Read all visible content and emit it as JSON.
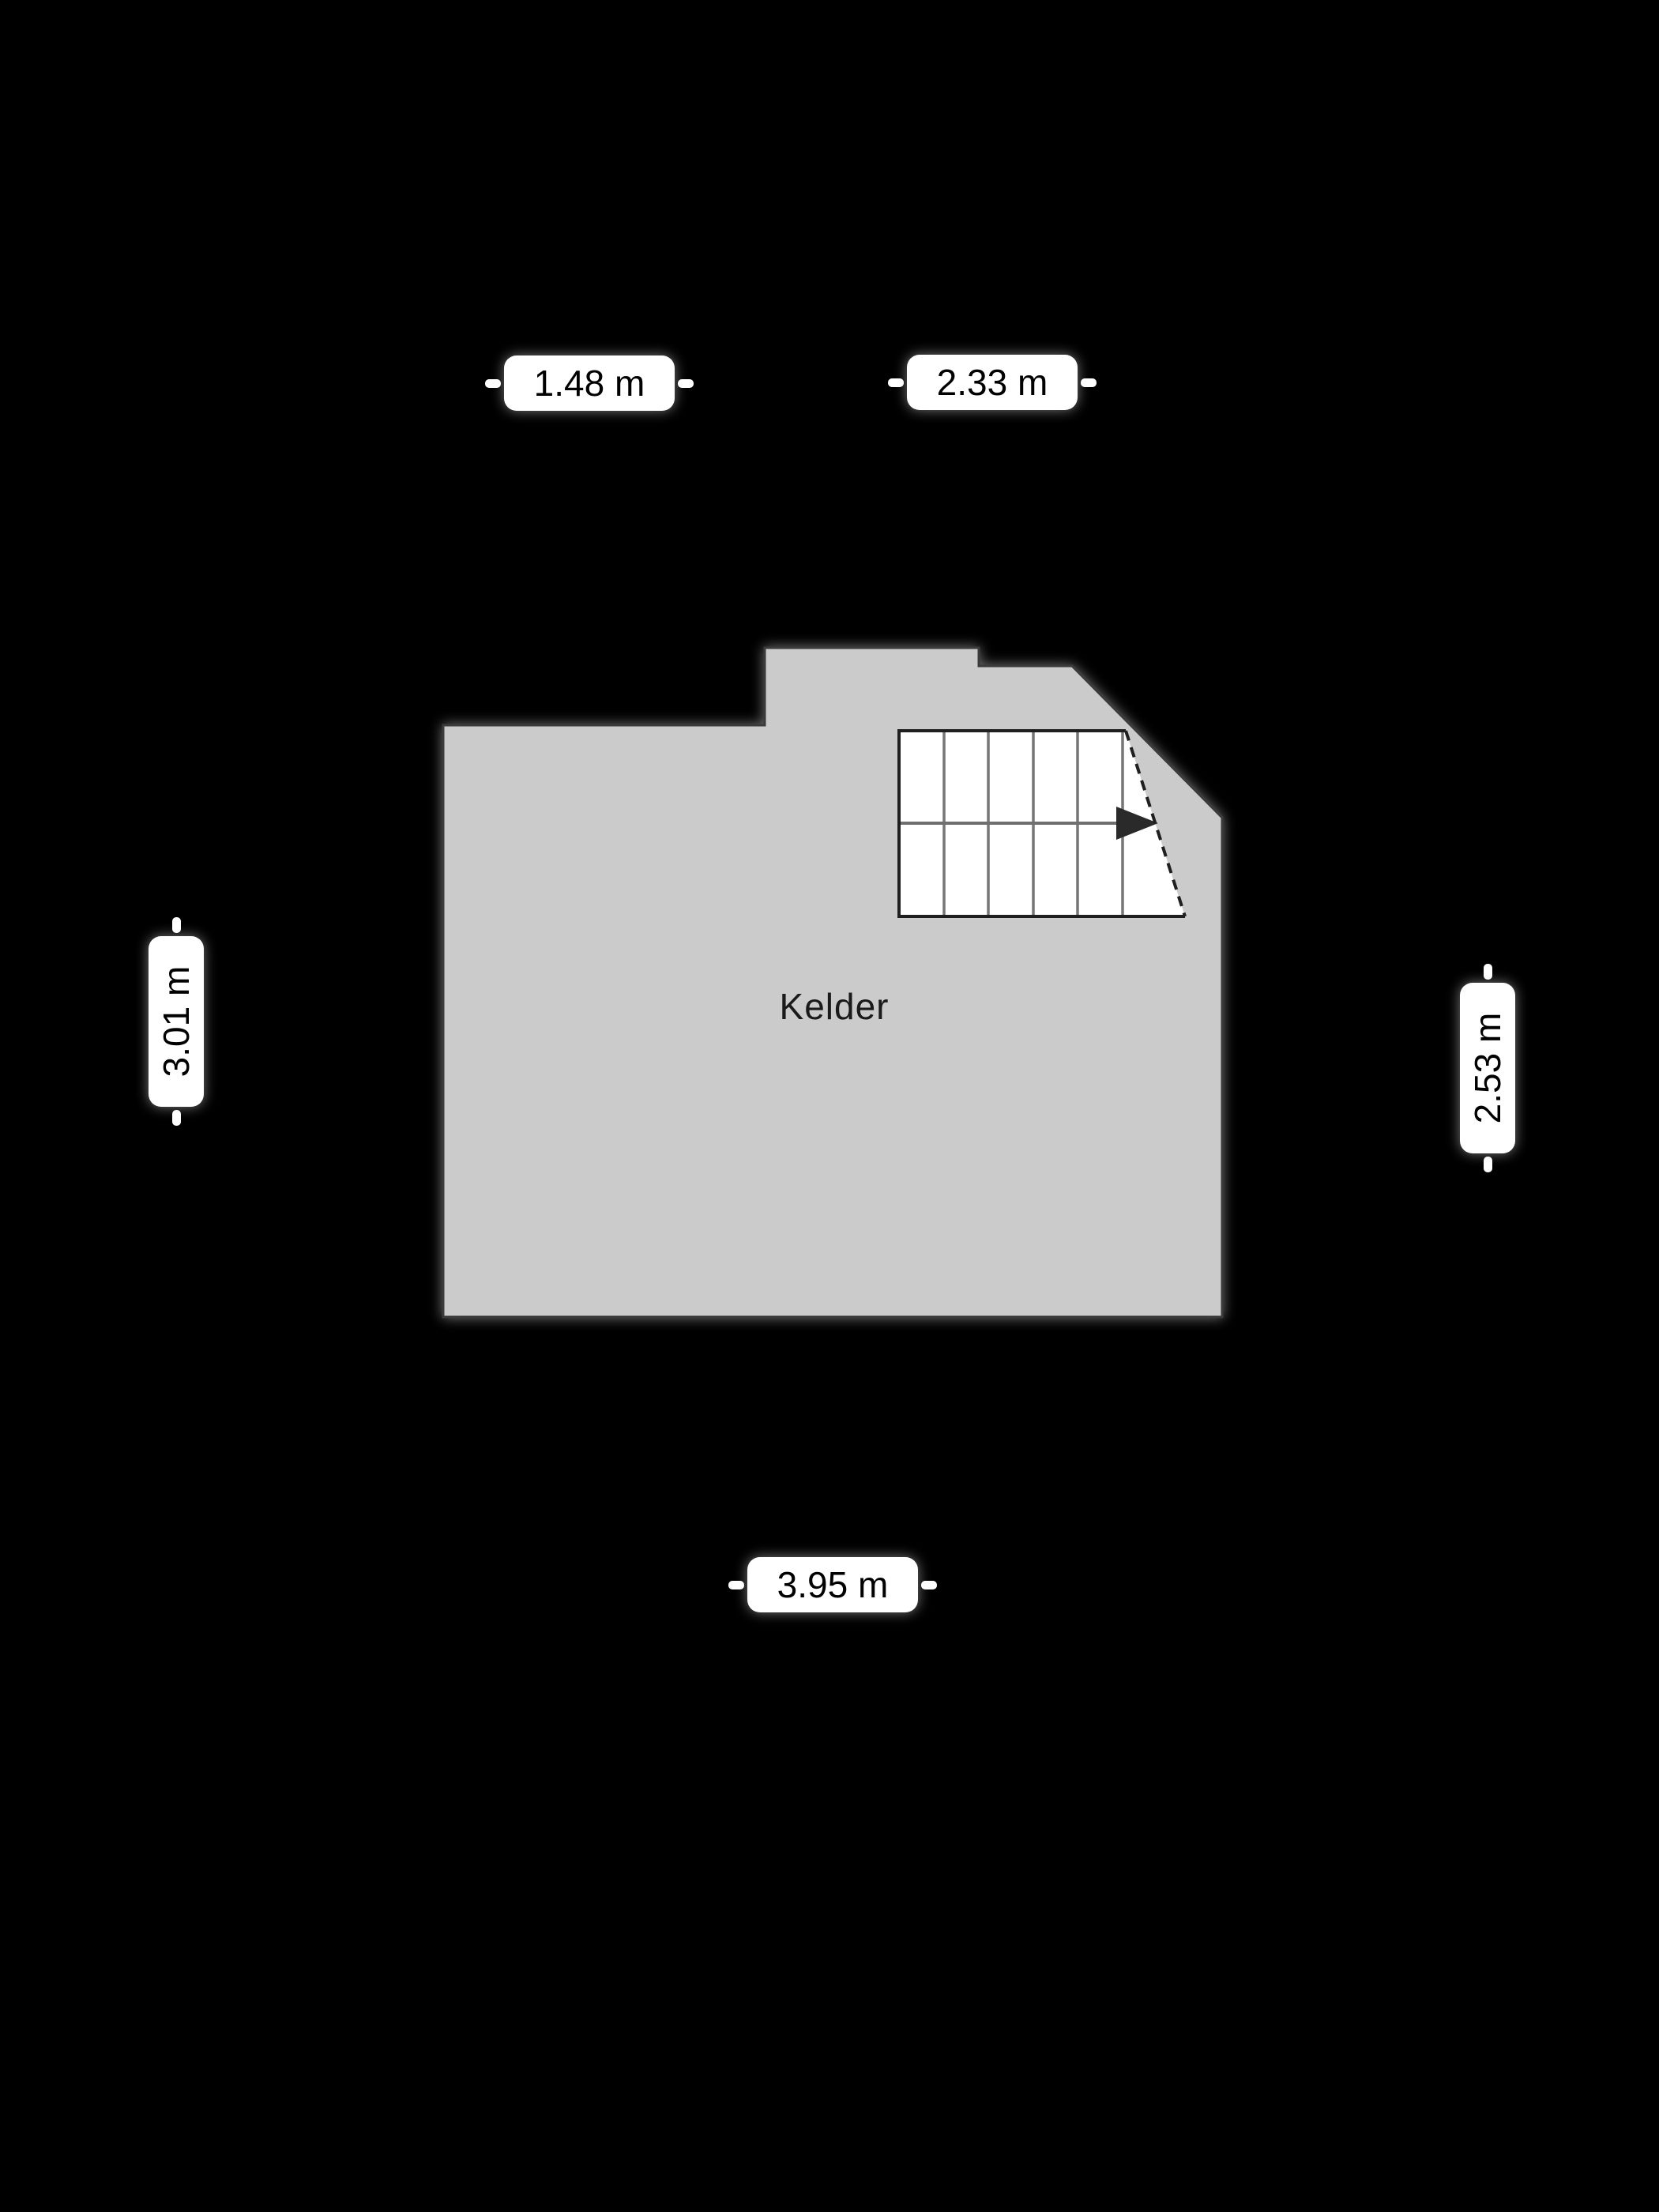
{
  "floorplan": {
    "room": {
      "label": "Kelder"
    },
    "dimensions": {
      "top_left": "1.48 m",
      "top_right": "2.33 m",
      "left": "3.01 m",
      "right": "2.53 m",
      "bottom": "3.95 m"
    }
  },
  "colors": {
    "background": "#000000",
    "room-fill": "#cbcbcb",
    "room-outline": "#3a3a3a",
    "stair-fill": "#ffffff",
    "stair-border": "#1f1f1f",
    "stair-step-line": "#767676",
    "arrow": "#2a2a2a",
    "label-bg": "#ffffff",
    "label-text": "#000000"
  }
}
